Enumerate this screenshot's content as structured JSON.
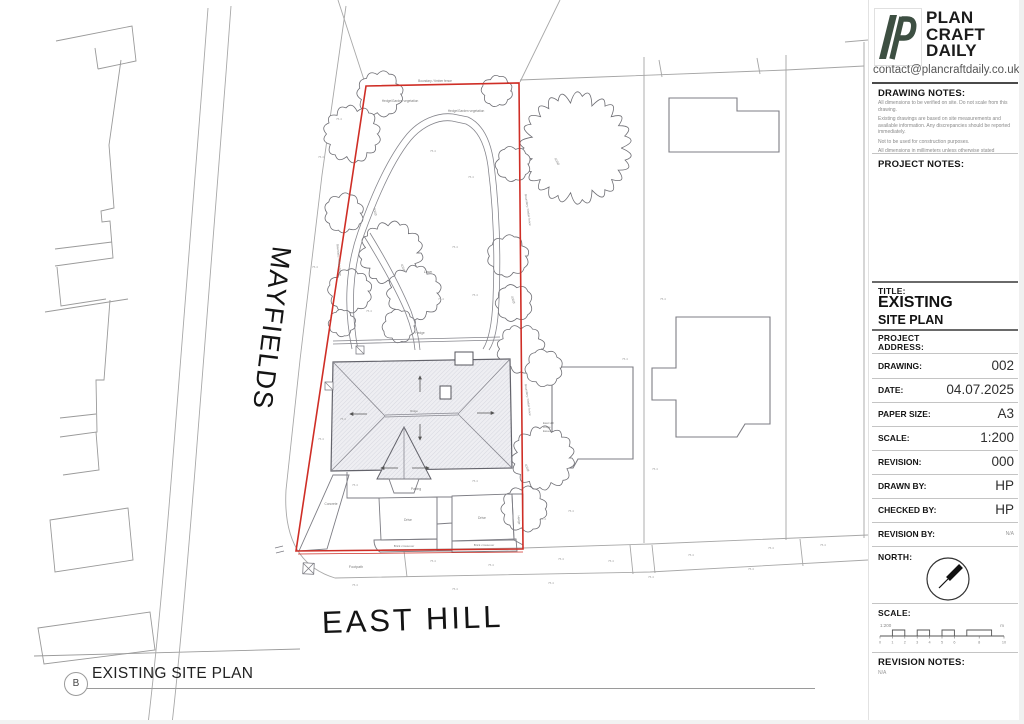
{
  "title_block": {
    "brand": {
      "name_lines": [
        "PLAN",
        "CRAFT",
        "DAILY"
      ],
      "contact": "contact@plancraftdaily.co.uk",
      "logo_color": "#3d4f42"
    },
    "drawing_notes": {
      "heading": "DRAWING NOTES:",
      "items": [
        "All dimensions to be verified on site. Do not scale from this drawing.",
        "Existing drawings are based on site measurements and available information. Any discrepancies should be reported immediately.",
        "Not to be used for construction purposes.",
        "All dimensions in millimeters unless otherwise stated"
      ]
    },
    "project_notes": {
      "heading": "PROJECT NOTES:"
    },
    "title_section": {
      "label": "TITLE:",
      "title_line1": "EXISTING",
      "title_line2": "SITE PLAN"
    },
    "address_section": {
      "label_line1": "PROJECT",
      "label_line2": "ADDRESS:"
    },
    "fields": [
      {
        "label": "DRAWING:",
        "value": "002"
      },
      {
        "label": "DATE:",
        "value": "04.07.2025"
      },
      {
        "label": "PAPER SIZE:",
        "value": "A3"
      },
      {
        "label": "SCALE:",
        "value": "1:200"
      },
      {
        "label": "REVISION:",
        "value": "000"
      },
      {
        "label": "DRAWN BY:",
        "value": "HP"
      },
      {
        "label": "CHECKED BY:",
        "value": "HP"
      },
      {
        "label": "REVISION BY:",
        "value": "N/A"
      }
    ],
    "north_section": {
      "label": "NORTH:"
    },
    "scale_section": {
      "label": "SCALE:",
      "ratio": "1:200",
      "unit": "m",
      "ticks": [
        "0",
        "1",
        "2",
        "3",
        "4",
        "5",
        "6",
        "8",
        "10"
      ]
    },
    "revision_notes": {
      "heading": "REVISION NOTES:",
      "value": "N/A"
    }
  },
  "plan": {
    "street_mayfields": "MAYFIELDS",
    "street_east_hill": "EAST HILL",
    "boundary_color": "#cf2e26",
    "labels": {
      "lawn": "Lawn",
      "paving": "Paving",
      "drive": "Drive",
      "hedge": "Hedge",
      "concrete": "Concrete",
      "footpath": "Footpath",
      "brick_crossover": "Brick crossover",
      "vegetation": "Hedge/Garden vegetation",
      "boundary": "Boundary / timber fence",
      "ridge": "Ridge",
      "tree_tag": "400Ø",
      "spot_level": "75.4",
      "neighbor_line1": "East Hill",
      "neighbor_line2": "Ridge",
      "neighbor_line3": "Eaves"
    }
  },
  "footer": {
    "ref": "B",
    "caption": "EXISTING SITE PLAN"
  }
}
